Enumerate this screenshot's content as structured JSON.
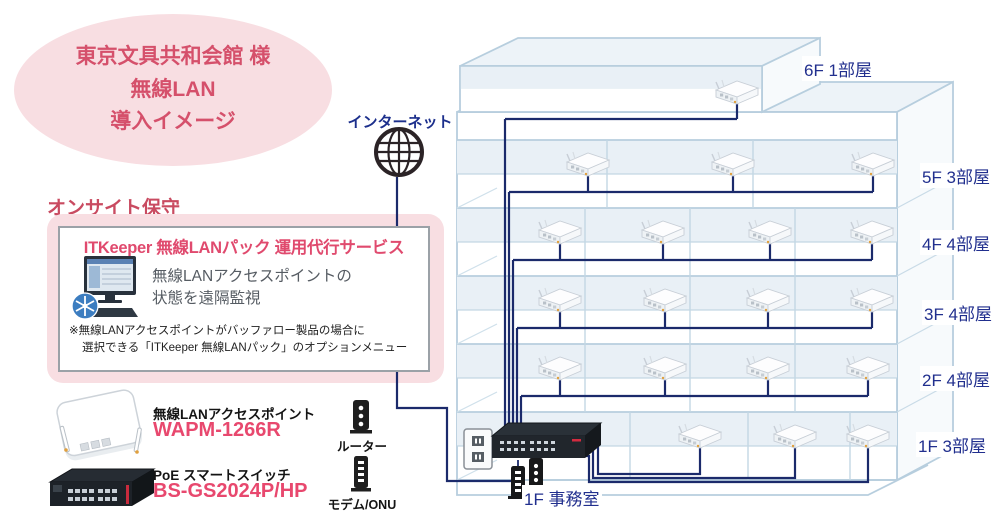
{
  "title_bubble": {
    "line1": "東京文具共和会館 様",
    "line2": "無線LAN",
    "line3": "導入イメージ"
  },
  "internet_label": "インターネット",
  "onsite_heading": "オンサイト保守",
  "service_panel": {
    "title": "ITKeeper 無線LANパック 運用代行サービス",
    "desc_line1": "無線LANアクセスポイントの",
    "desc_line2": "状態を遠隔監視",
    "note_line1": "※無線LANアクセスポイントがバッファロー製品の場合に",
    "note_line2": "選択できる「ITKeeper 無線LANパック」のオプションメニュー"
  },
  "legend": {
    "ap_type": "無線LANアクセスポイント",
    "ap_model": "WAPM-1266R",
    "switch_type": "PoE スマートスイッチ",
    "switch_model": "BS-GS2024P/HP",
    "router": "ルーター",
    "modem": "モデム/ONU"
  },
  "building": {
    "floors": [
      {
        "label": "6F 1部屋",
        "rooms": 1,
        "access_points": 1
      },
      {
        "label": "5F 3部屋",
        "rooms": 3,
        "access_points": 3
      },
      {
        "label": "4F 4部屋",
        "rooms": 4,
        "access_points": 4
      },
      {
        "label": "3F 4部屋",
        "rooms": 4,
        "access_points": 4
      },
      {
        "label": "2F 4部屋",
        "rooms": 4,
        "access_points": 4
      },
      {
        "label": "1F 3部屋",
        "rooms": 3,
        "access_points": 3
      }
    ],
    "office_label": "1F 事務室",
    "total_access_points": 19
  },
  "colors": {
    "accent_pink": "#e8486e",
    "heading_red": "#c94b61",
    "bubble_bg": "#f8dee2",
    "bubble_text": "#d5506b",
    "cable_navy": "#1b2a6b",
    "label_navy": "#212f8e",
    "building_line": "#b7cede",
    "room_fill": "#e9f0f6",
    "red_connector": "#e03147"
  }
}
